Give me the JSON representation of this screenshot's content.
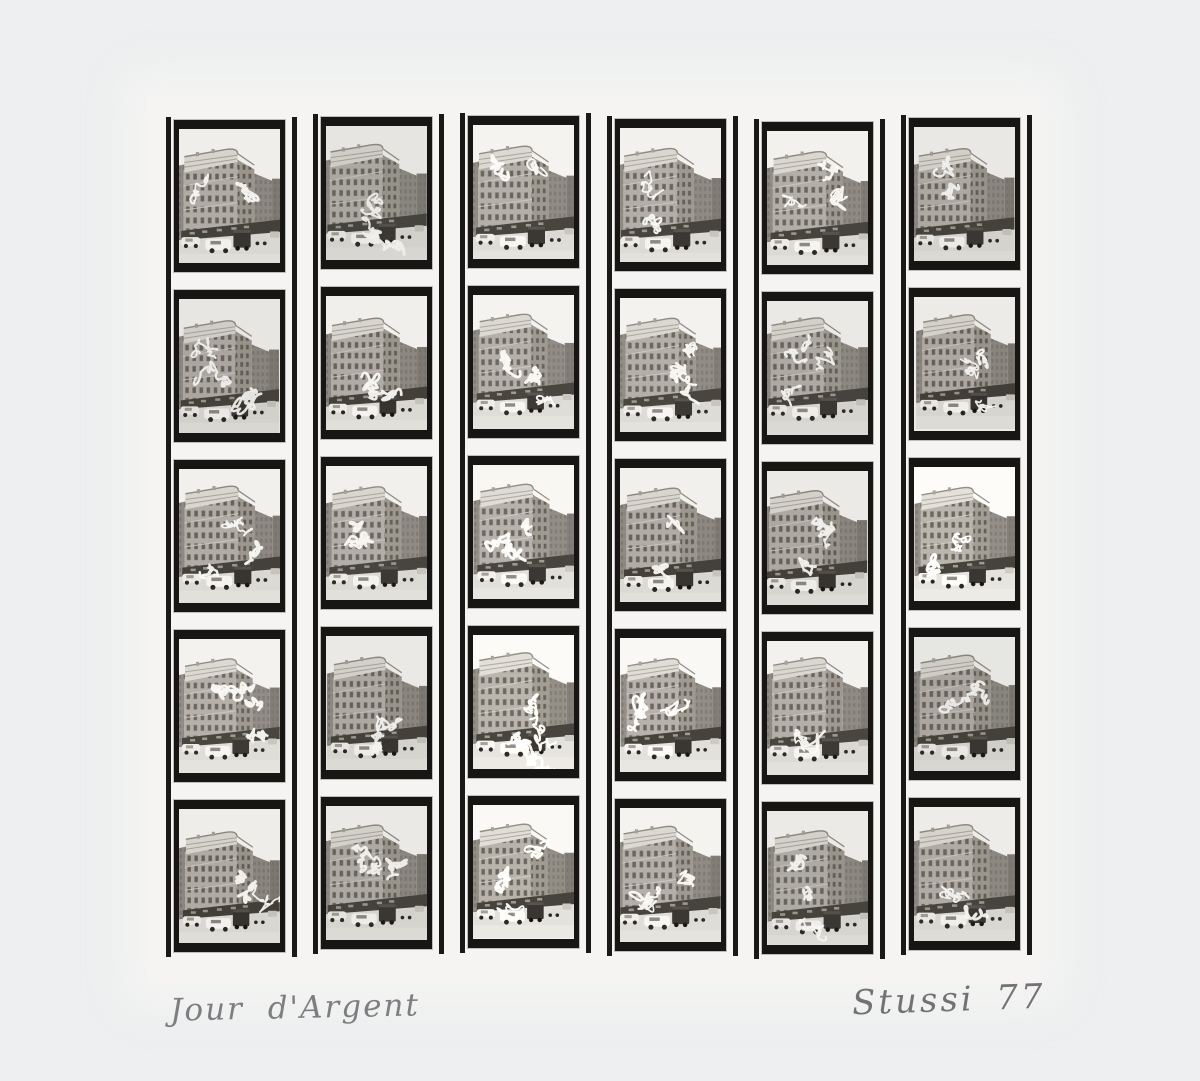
{
  "artwork": {
    "caption": "Jour d'Argent",
    "signature": "Stussi 77"
  },
  "contact_sheet": {
    "columns": 6,
    "rows": 5,
    "frame_subject": "corner building street scene with parked cars, white scribble overpainting",
    "strips": [
      {
        "frames": [
          {
            "id": "1-1",
            "seed": 23
          },
          {
            "id": "1-2",
            "seed": 71
          },
          {
            "id": "1-3",
            "seed": 8
          },
          {
            "id": "1-4",
            "seed": 54
          },
          {
            "id": "1-5",
            "seed": 39
          }
        ]
      },
      {
        "frames": [
          {
            "id": "2-1",
            "seed": 12
          },
          {
            "id": "2-2",
            "seed": 85
          },
          {
            "id": "2-3",
            "seed": 47
          },
          {
            "id": "2-4",
            "seed": 66
          },
          {
            "id": "2-5",
            "seed": 3
          }
        ]
      },
      {
        "frames": [
          {
            "id": "3-1",
            "seed": 91
          },
          {
            "id": "3-2",
            "seed": 28
          },
          {
            "id": "3-3",
            "seed": 57
          },
          {
            "id": "3-4",
            "seed": 14
          },
          {
            "id": "3-5",
            "seed": 72
          }
        ]
      },
      {
        "frames": [
          {
            "id": "4-1",
            "seed": 36
          },
          {
            "id": "4-2",
            "seed": 9
          },
          {
            "id": "4-3",
            "seed": 63
          },
          {
            "id": "4-4",
            "seed": 81
          },
          {
            "id": "4-5",
            "seed": 45
          }
        ]
      },
      {
        "frames": [
          {
            "id": "5-1",
            "seed": 18
          },
          {
            "id": "5-2",
            "seed": 52
          },
          {
            "id": "5-3",
            "seed": 77
          },
          {
            "id": "5-4",
            "seed": 31
          },
          {
            "id": "5-5",
            "seed": 88
          }
        ]
      },
      {
        "frames": [
          {
            "id": "6-1",
            "seed": 5
          },
          {
            "id": "6-2",
            "seed": 41
          },
          {
            "id": "6-3",
            "seed": 69
          },
          {
            "id": "6-4",
            "seed": 26
          },
          {
            "id": "6-5",
            "seed": 94
          }
        ]
      }
    ]
  },
  "colors": {
    "background": "#edeff0",
    "mount_paper": "#f5f4f2",
    "film_black": "#171615",
    "pencil": "#7e7e82",
    "scribble_white": "#fcfbf7"
  }
}
